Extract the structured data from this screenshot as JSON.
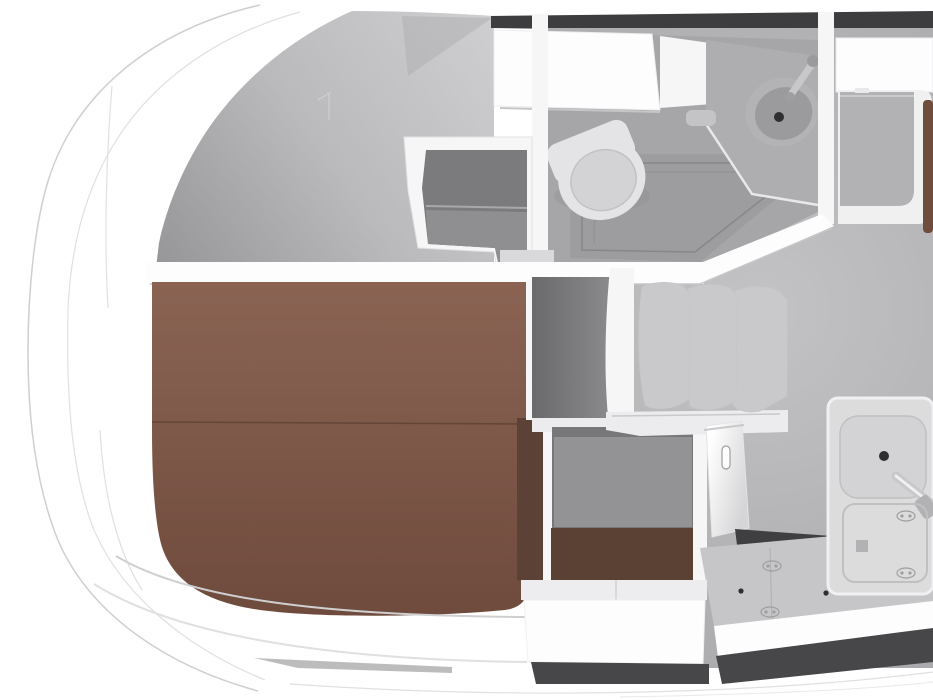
{
  "scene": {
    "title": "Yacht interior floor plan - top-down cutaway 3D render",
    "view": "top-down",
    "rooms": [
      {
        "name": "bow-cabin",
        "features": [
          "island-berth",
          "vanity-shelf-unit",
          "curved-hull-deck"
        ]
      },
      {
        "name": "head-bathroom",
        "features": [
          "toilet",
          "wash-basin",
          "basin-faucet",
          "shower-tray",
          "overhead-cabinet",
          "corner-counter"
        ]
      },
      {
        "name": "salon",
        "features": [
          "settee-three-seat-backs",
          "locker-with-handle",
          "storage-bench",
          "companionway-recess"
        ]
      },
      {
        "name": "galley",
        "features": [
          "sink",
          "sink-faucet",
          "worktop",
          "latched-lockers"
        ]
      },
      {
        "name": "wardrobe",
        "features": [
          "white-cabinet",
          "shelf",
          "wood-door-trim"
        ]
      }
    ]
  },
  "palette": {
    "white": "#ffffff",
    "bright": "#fdfdfe",
    "wall": "#f6f6f7",
    "rim": "#f0f0f1",
    "hullLine1": "#cfcfd1",
    "hullLine2": "#e0e0e2",
    "cutBand": "#3d3d3f",
    "underBand": "#47474a",
    "ceil0": "#97979a",
    "ceil1": "#bababc",
    "ceil2": "#cdcdcf",
    "ceilWedge": "#aeaeb0",
    "floor0": "#c3c3c5",
    "floor1": "#a8a8ab",
    "bathFloor": "#a6a6a8",
    "shower": "#9d9da0",
    "showerLine": "#87878a",
    "counterTop": "#aeaeb0",
    "counterEdge": "#e9e9eb",
    "soap": "#c4c4c6",
    "sinkRim": "#b3b3b5",
    "sinkBowl": "#9b9b9d",
    "drain": "#2f2f31",
    "toiletBody": "#e4e4e6",
    "toiletSeat": "#d3d3d5",
    "toiletShadow": "#8e8e90",
    "deskIn0": "#7b7b7e",
    "deskIn1": "#8f8f92",
    "sill": "#d9d9db",
    "wardrobeFloor": "#b2b2b4",
    "wood": "#6f4c3b",
    "wood2": "#5b4334",
    "bed0": "#8a6353",
    "bed1": "#6f4b3d",
    "bedSeam": "#5e4033",
    "bedSide": "#5c4136",
    "recess0": "#6a6a6d",
    "recess1": "#8b8b8e",
    "panel": "#939396",
    "panelEdge": "#77777a",
    "underBrown": "#5a4134",
    "seat0": "#f6f6f7",
    "seat1": "#e3e3e5",
    "seat2": "#c9c9cb",
    "seatLine": "#c6c6c8",
    "seatBase": "#ececee",
    "fridge0": "#fefefe",
    "fridge1": "#d5d5d7",
    "handle": "#b9b9bb",
    "groove": "#3f3f41",
    "counter": "#c6c6c8",
    "latch": "#9e9ea0",
    "unit": "#dcdcdd",
    "basin": "#d3d3d5",
    "basinLine": "#c0c0c2",
    "chrome": "#c8c8ca",
    "chromeHi": "#f0f0f2",
    "benchTop": "#ededef",
    "shadowLine": "#c6c6c8"
  }
}
